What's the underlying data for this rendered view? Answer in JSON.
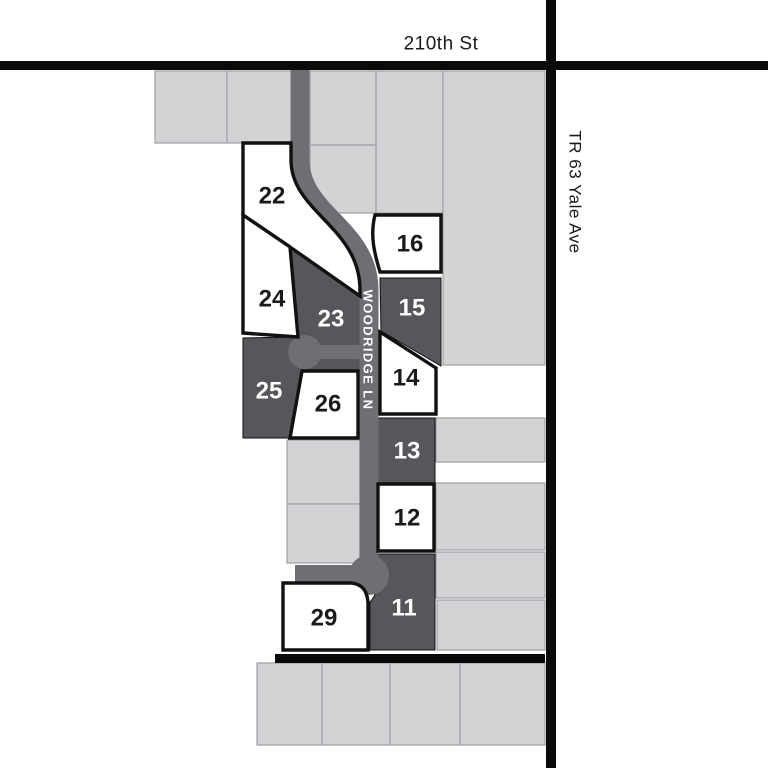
{
  "map": {
    "width": 768,
    "height": 768,
    "colors": {
      "background": "#ffffff",
      "parcel_fill": "#d2d3d5",
      "parcel_border": "#a0a1a4",
      "road_gray": "#6e6f73",
      "dark_lot": "#56575b",
      "black_road": "#0a0a0a",
      "lot_border": "#111111",
      "white_lot": "#ffffff",
      "label_dark": "#1a1a1a",
      "label_light": "#ffffff"
    },
    "streets": [
      {
        "id": "210th-st-label",
        "label": "210th St",
        "x": 441,
        "y": 44,
        "rotate": 0,
        "size": 19,
        "tone": "dark",
        "weight": "normal",
        "spacing": "0.5"
      },
      {
        "id": "tr63-yale-ave-label",
        "label": "TR 63 Yale Ave",
        "x": 575,
        "y": 192,
        "rotate": 90,
        "size": 17,
        "tone": "dark",
        "weight": "normal",
        "spacing": "0.5"
      },
      {
        "id": "woodridge-ln-label",
        "label": "WOODRIDGE LN",
        "x": 368,
        "y": 350,
        "rotate": 90,
        "size": 13,
        "tone": "light",
        "weight": "bold",
        "spacing": "1.4"
      }
    ],
    "black_roads": [
      {
        "id": "210th-st-roadway",
        "x": 0,
        "y": 61,
        "w": 768,
        "h": 9
      },
      {
        "id": "tr63-yale-ave-roadway",
        "x": 546,
        "y": 0,
        "w": 10,
        "h": 768
      },
      {
        "id": "south-boundary-roadway",
        "x": 275,
        "y": 654,
        "w": 270,
        "h": 9
      }
    ],
    "parcels": [
      {
        "id": "parcel-nw-1",
        "x": 155,
        "y": 71,
        "w": 72,
        "h": 72
      },
      {
        "id": "parcel-nw-2",
        "x": 227,
        "y": 71,
        "w": 65,
        "h": 72
      },
      {
        "id": "parcel-n-1",
        "x": 310,
        "y": 71,
        "w": 66,
        "h": 74
      },
      {
        "id": "parcel-n-2",
        "x": 310,
        "y": 145,
        "w": 66,
        "h": 68
      },
      {
        "id": "parcel-n-3",
        "x": 376,
        "y": 71,
        "w": 67,
        "h": 142
      },
      {
        "id": "parcel-e-large",
        "x": 443,
        "y": 71,
        "w": 102,
        "h": 294
      },
      {
        "id": "parcel-e-2",
        "x": 436,
        "y": 418,
        "w": 109,
        "h": 44
      },
      {
        "id": "parcel-e-3",
        "x": 436,
        "y": 483,
        "w": 109,
        "h": 67
      },
      {
        "id": "parcel-e-4",
        "x": 436,
        "y": 552,
        "w": 109,
        "h": 46
      },
      {
        "id": "parcel-e-5",
        "x": 437,
        "y": 600,
        "w": 108,
        "h": 50
      },
      {
        "id": "parcel-w-1",
        "x": 287,
        "y": 440,
        "w": 73,
        "h": 64
      },
      {
        "id": "parcel-w-2",
        "x": 287,
        "y": 504,
        "w": 73,
        "h": 59
      },
      {
        "id": "parcel-s-1",
        "x": 257,
        "y": 663,
        "w": 65,
        "h": 82
      },
      {
        "id": "parcel-s-2",
        "x": 322,
        "y": 663,
        "w": 68,
        "h": 82
      },
      {
        "id": "parcel-s-3",
        "x": 390,
        "y": 663,
        "w": 70,
        "h": 82
      },
      {
        "id": "parcel-s-4",
        "x": 460,
        "y": 663,
        "w": 85,
        "h": 82
      }
    ],
    "road_paths": [
      {
        "id": "woodridge-ln-roadway",
        "d": "M300,62 L300,160 C300,214 369,228 369,290 L369,562",
        "w": 19
      },
      {
        "id": "woodridge-court-branch",
        "d": "M305,352 L362,352",
        "w": 14
      },
      {
        "id": "woodridge-south-stub",
        "d": "M295,574 L369,574",
        "w": 18
      }
    ],
    "road_circles": [
      {
        "id": "woodridge-court-bulb",
        "cx": 305,
        "cy": 352,
        "r": 17
      },
      {
        "id": "woodridge-south-bulb",
        "cx": 369,
        "cy": 575,
        "r": 20
      }
    ],
    "dark_lots": [
      {
        "id": "lot-23-25-block",
        "d": "M290,247 L360,297 L360,371 L302,371 L290,438 L243,438 L243,338 L298,337 Z"
      },
      {
        "id": "lot-15-shape",
        "d": "M380,278 L441,278 L441,366 L381,331 Z"
      },
      {
        "id": "lot-13-shape",
        "d": "M378,418 L435,418 L435,483 L378,483 Z"
      },
      {
        "id": "lot-11-shape",
        "d": "M377,554 L435,554 L435,650 L370,650 L370,602 A29,29 0 0 0 377,576 Z"
      }
    ],
    "white_lots": [
      {
        "id": "lot-22-shape",
        "d": "M243,143 L291,143 L291,160 C291,212 360,227 360,290 L360,296 L290,247 L243,215 Z"
      },
      {
        "id": "lot-24-shape",
        "d": "M243,215 L290,247 L298,337 L243,333 Z"
      },
      {
        "id": "lot-26-shape",
        "d": "M302,371 L358,371 L358,438 L290,438 Z"
      },
      {
        "id": "lot-16-shape",
        "d": "M375,215 L441,215 L441,272 L380,272 C374,252 370,235 375,215 Z"
      },
      {
        "id": "lot-14-shape",
        "d": "M380,332 L436,368 L436,414 L380,414 Z"
      },
      {
        "id": "lot-12-shape",
        "d": "M378,484 L434,484 L434,551 L378,551 Z"
      },
      {
        "id": "lot-29-shape",
        "d": "M283,583 L351,583 Q361,584 365,591 Q368,597 368,604 L368,650 L283,650 Z"
      }
    ],
    "lot_labels": [
      {
        "number": "22",
        "x": 272,
        "y": 196,
        "tone": "dark"
      },
      {
        "number": "24",
        "x": 272,
        "y": 299,
        "tone": "dark"
      },
      {
        "number": "23",
        "x": 331,
        "y": 319,
        "tone": "light"
      },
      {
        "number": "25",
        "x": 269,
        "y": 391,
        "tone": "light"
      },
      {
        "number": "26",
        "x": 328,
        "y": 404,
        "tone": "dark"
      },
      {
        "number": "16",
        "x": 410,
        "y": 244,
        "tone": "dark"
      },
      {
        "number": "15",
        "x": 412,
        "y": 308,
        "tone": "light"
      },
      {
        "number": "14",
        "x": 406,
        "y": 378,
        "tone": "dark"
      },
      {
        "number": "13",
        "x": 407,
        "y": 451,
        "tone": "light"
      },
      {
        "number": "12",
        "x": 407,
        "y": 518,
        "tone": "dark"
      },
      {
        "number": "11",
        "x": 404,
        "y": 608,
        "tone": "light"
      },
      {
        "number": "29",
        "x": 324,
        "y": 618,
        "tone": "dark"
      }
    ]
  }
}
